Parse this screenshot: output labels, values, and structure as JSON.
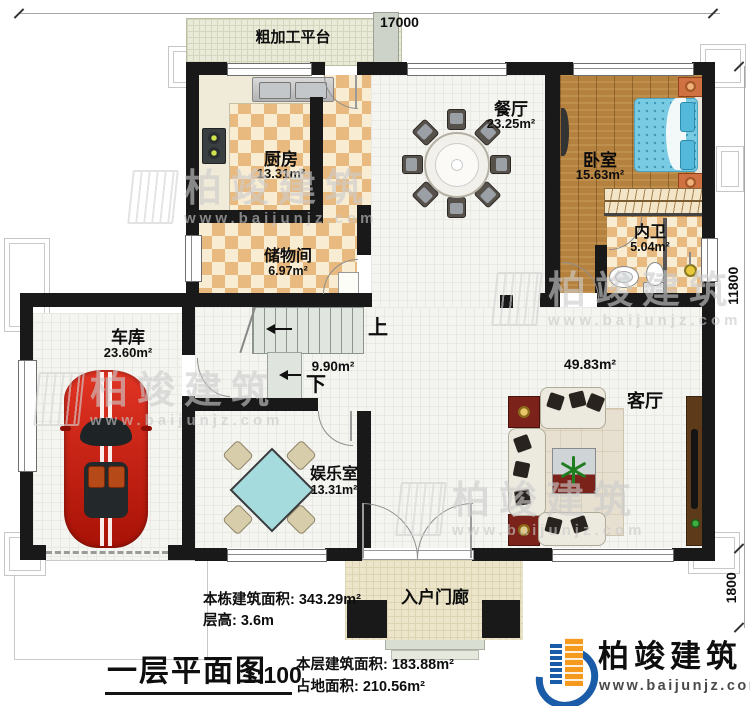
{
  "dimensions": {
    "top": "17000",
    "right_upper": "11800",
    "right_lower": "1800"
  },
  "rooms": {
    "platform": {
      "name": "粗加工平台"
    },
    "kitchen": {
      "name": "厨房",
      "area": "13.31m²"
    },
    "dining": {
      "name": "餐厅",
      "area": "23.25m²"
    },
    "bedroom": {
      "name": "卧室",
      "area": "15.63m²"
    },
    "ensuite": {
      "name": "内卫",
      "area": "5.04m²"
    },
    "storage": {
      "name": "储物间",
      "area": "6.97m²"
    },
    "garage": {
      "name": "车库",
      "area": "23.60m²"
    },
    "entertainment": {
      "name": "娱乐室",
      "area": "13.31m²"
    },
    "living": {
      "name": "客厅",
      "area": "49.83m²"
    },
    "porch": {
      "name": "入户门廊"
    },
    "stairs": {
      "area": "9.90m²",
      "up": "上",
      "down": "下"
    }
  },
  "annotations": {
    "building_area": "本栋建筑面积: 343.29m²",
    "floor_height": "层高: 3.6m",
    "title": "一层平面图",
    "scale": "1:100",
    "floor_area": "本层建筑面积: 183.88m²",
    "footprint": "占地面积: 210.56m²"
  },
  "branding": {
    "logo_text": "柏竣建筑",
    "website": "www.baijunjz.com"
  },
  "watermark": {
    "text": "柏竣建筑",
    "website": "www.baijunjz.com"
  },
  "colors": {
    "wall": "#191919",
    "checker_dark": "#e8ba7f",
    "checker_light": "#f8ecd3",
    "wood_floor": "#b5813f",
    "bed_blue": "#79cbe4",
    "car_red": "#d42114",
    "table_teal": "#a6dbde",
    "logo_blue": "#1b5ca8",
    "logo_orange": "#f59a1d"
  }
}
